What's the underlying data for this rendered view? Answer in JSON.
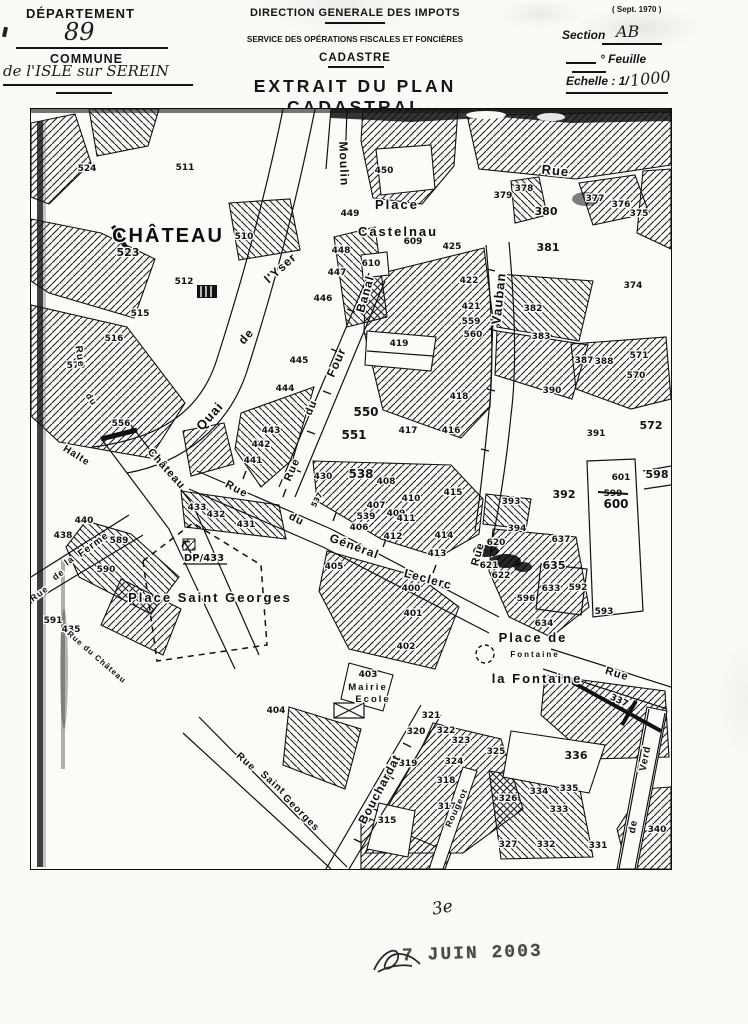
{
  "header": {
    "left": {
      "departement_label": "DÉPARTEMENT",
      "departement_value": "89",
      "commune_label": "COMMUNE",
      "commune_value": "de l'ISLE sur SEREIN"
    },
    "center": {
      "administration": "DIRECTION GENERALE DES IMPOTS",
      "service": "SERVICE DES OPÉRATIONS FISCALES ET FONCIÈRES",
      "cadastre": "CADASTRE",
      "title": "EXTRAIT DU PLAN CADASTRAL"
    },
    "right": {
      "edition": "( Sept. 1970 )",
      "section_label": "Section",
      "section_value": "AB",
      "feuille_label": "° Feuille",
      "echelle_label": "Echelle : 1/",
      "echelle_value": "1000"
    }
  },
  "map": {
    "places": [
      {
        "label": "CHÂTEAU",
        "x": 137,
        "y": 133,
        "fs": 20,
        "ls": 5
      },
      {
        "label": "Place",
        "x": 366,
        "y": 100,
        "fs": 13,
        "ls": 2
      },
      {
        "label": "Castelnau",
        "x": 367,
        "y": 127,
        "fs": 13,
        "ls": 1
      },
      {
        "label": "Place  Saint  Georges",
        "x": 179,
        "y": 493,
        "fs": 13,
        "ls": 1
      },
      {
        "label": "Place  de",
        "x": 502,
        "y": 533,
        "fs": 13,
        "ls": 1
      },
      {
        "label": "la Fontaine",
        "x": 506,
        "y": 574,
        "fs": 13,
        "ls": 1
      },
      {
        "label": "Fontaine",
        "x": 504,
        "y": 548,
        "fs": 8,
        "ls": 0
      },
      {
        "label": "Mairie",
        "x": 337,
        "y": 581,
        "fs": 9.5,
        "ls": 1
      },
      {
        "label": "Ecole",
        "x": 342,
        "y": 593,
        "fs": 9.5,
        "ls": 1
      }
    ],
    "streets": [
      {
        "label": "Moulin",
        "x": 309,
        "y": 55,
        "r": 88,
        "fs": 12
      },
      {
        "label": "Rue",
        "x": 524,
        "y": 66,
        "r": 6,
        "fs": 13
      },
      {
        "label": "Quai",
        "x": 182,
        "y": 310,
        "r": -48,
        "fs": 13
      },
      {
        "label": "de",
        "x": 218,
        "y": 230,
        "r": -48,
        "fs": 12
      },
      {
        "label": "l'Yser",
        "x": 252,
        "y": 162,
        "r": -42,
        "fs": 12
      },
      {
        "label": "Rue",
        "x": 264,
        "y": 362,
        "r": -66,
        "fs": 11
      },
      {
        "label": "du",
        "x": 283,
        "y": 300,
        "r": -66,
        "fs": 11
      },
      {
        "label": "Four",
        "x": 309,
        "y": 255,
        "r": -66,
        "fs": 12
      },
      {
        "label": "Banal",
        "x": 338,
        "y": 186,
        "r": -74,
        "fs": 12
      },
      {
        "label": "Vauban",
        "x": 472,
        "y": 190,
        "r": -84,
        "fs": 13
      },
      {
        "label": "Rue",
        "x": 450,
        "y": 446,
        "r": -75,
        "fs": 11
      },
      {
        "label": "Rue",
        "x": 204,
        "y": 383,
        "r": 28,
        "fs": 11
      },
      {
        "label": "du",
        "x": 264,
        "y": 413,
        "r": 28,
        "fs": 11
      },
      {
        "label": "Général",
        "x": 322,
        "y": 441,
        "r": 20,
        "fs": 12
      },
      {
        "label": "Leclerc",
        "x": 396,
        "y": 474,
        "r": 15,
        "fs": 12
      },
      {
        "label": "Bouchardat",
        "x": 352,
        "y": 682,
        "r": -62,
        "fs": 12
      },
      {
        "label": "Rue",
        "x": 213,
        "y": 655,
        "r": 42,
        "fs": 10
      },
      {
        "label": "Saint",
        "x": 240,
        "y": 676,
        "r": 42,
        "fs": 10
      },
      {
        "label": "Georges",
        "x": 268,
        "y": 706,
        "r": 45,
        "fs": 10
      },
      {
        "label": "Rue",
        "x": 46,
        "y": 248,
        "r": 82,
        "fs": 10
      },
      {
        "label": "du",
        "x": 58,
        "y": 292,
        "r": 55,
        "fs": 9
      },
      {
        "label": "Château",
        "x": 133,
        "y": 362,
        "r": 48,
        "fs": 11
      },
      {
        "label": "Halte",
        "x": 44,
        "y": 349,
        "r": 32,
        "fs": 10
      },
      {
        "label": "Rue du Château",
        "x": 64,
        "y": 550,
        "r": 41,
        "fs": 8
      },
      {
        "label": "Rue",
        "x": 10,
        "y": 487,
        "r": -36,
        "fs": 9
      },
      {
        "label": "de",
        "x": 29,
        "y": 468,
        "r": -36,
        "fs": 9
      },
      {
        "label": "la",
        "x": 40,
        "y": 454,
        "r": -36,
        "fs": 9
      },
      {
        "label": "Ferme",
        "x": 64,
        "y": 438,
        "r": -36,
        "fs": 10
      },
      {
        "label": "Rue",
        "x": 585,
        "y": 568,
        "r": 17,
        "fs": 11
      },
      {
        "label": "Verd",
        "x": 617,
        "y": 650,
        "r": -79,
        "fs": 10
      },
      {
        "label": "de",
        "x": 605,
        "y": 718,
        "r": -79,
        "fs": 10
      },
      {
        "label": "Rougeot",
        "x": 428,
        "y": 700,
        "r": -65,
        "fs": 8.5
      }
    ],
    "parcels": [
      {
        "n": "524",
        "x": 56,
        "y": 62
      },
      {
        "n": "511",
        "x": 154,
        "y": 61
      },
      {
        "n": "510",
        "x": 213,
        "y": 130
      },
      {
        "n": "523",
        "x": 97,
        "y": 147,
        "fs": 11
      },
      {
        "n": "512",
        "x": 153,
        "y": 175
      },
      {
        "n": "515",
        "x": 109,
        "y": 207
      },
      {
        "n": "516",
        "x": 83,
        "y": 232
      },
      {
        "n": "570",
        "x": 45,
        "y": 259
      },
      {
        "n": "556",
        "x": 90,
        "y": 317
      },
      {
        "n": "440",
        "x": 53,
        "y": 414
      },
      {
        "n": "438",
        "x": 32,
        "y": 429
      },
      {
        "n": "589",
        "x": 88,
        "y": 434
      },
      {
        "n": "590",
        "x": 75,
        "y": 463
      },
      {
        "n": "591",
        "x": 22,
        "y": 514
      },
      {
        "n": "435",
        "x": 40,
        "y": 523
      },
      {
        "n": "450",
        "x": 353,
        "y": 64
      },
      {
        "n": "449",
        "x": 319,
        "y": 107
      },
      {
        "n": "448",
        "x": 310,
        "y": 144
      },
      {
        "n": "447",
        "x": 306,
        "y": 166
      },
      {
        "n": "446",
        "x": 292,
        "y": 192
      },
      {
        "n": "609",
        "x": 382,
        "y": 135
      },
      {
        "n": "610",
        "x": 340,
        "y": 157
      },
      {
        "n": "425",
        "x": 421,
        "y": 140
      },
      {
        "n": "422",
        "x": 438,
        "y": 174
      },
      {
        "n": "421",
        "x": 440,
        "y": 200
      },
      {
        "n": "559",
        "x": 440,
        "y": 215
      },
      {
        "n": "560",
        "x": 442,
        "y": 228
      },
      {
        "n": "419",
        "x": 368,
        "y": 237
      },
      {
        "n": "445",
        "x": 268,
        "y": 254
      },
      {
        "n": "444",
        "x": 254,
        "y": 282
      },
      {
        "n": "443",
        "x": 240,
        "y": 324
      },
      {
        "n": "442",
        "x": 230,
        "y": 338
      },
      {
        "n": "441",
        "x": 222,
        "y": 354
      },
      {
        "n": "550",
        "x": 335,
        "y": 307,
        "fs": 12
      },
      {
        "n": "551",
        "x": 323,
        "y": 330,
        "fs": 12
      },
      {
        "n": "379",
        "x": 472,
        "y": 89
      },
      {
        "n": "378",
        "x": 493,
        "y": 82
      },
      {
        "n": "380",
        "x": 515,
        "y": 106,
        "fs": 11
      },
      {
        "n": "381",
        "x": 517,
        "y": 142,
        "fs": 11
      },
      {
        "n": "377",
        "x": 564,
        "y": 92
      },
      {
        "n": "376",
        "x": 590,
        "y": 98
      },
      {
        "n": "375",
        "x": 608,
        "y": 107
      },
      {
        "n": "374",
        "x": 602,
        "y": 179
      },
      {
        "n": "382",
        "x": 502,
        "y": 202
      },
      {
        "n": "383",
        "x": 510,
        "y": 230
      },
      {
        "n": "418",
        "x": 428,
        "y": 290
      },
      {
        "n": "417",
        "x": 377,
        "y": 324
      },
      {
        "n": "416",
        "x": 420,
        "y": 324
      },
      {
        "n": "415",
        "x": 422,
        "y": 386
      },
      {
        "n": "414",
        "x": 413,
        "y": 429
      },
      {
        "n": "413",
        "x": 406,
        "y": 447
      },
      {
        "n": "387",
        "x": 553,
        "y": 254
      },
      {
        "n": "388",
        "x": 573,
        "y": 255
      },
      {
        "n": "571",
        "x": 608,
        "y": 249
      },
      {
        "n": "570",
        "x": 605,
        "y": 269
      },
      {
        "n": "390",
        "x": 521,
        "y": 284
      },
      {
        "n": "391",
        "x": 565,
        "y": 327
      },
      {
        "n": "572",
        "x": 620,
        "y": 320,
        "fs": 11
      },
      {
        "n": "598",
        "x": 626,
        "y": 369,
        "fs": 11
      },
      {
        "n": "601",
        "x": 590,
        "y": 371
      },
      {
        "n": "599",
        "x": 582,
        "y": 387,
        "strike": true
      },
      {
        "n": "600",
        "x": 585,
        "y": 399,
        "fs": 12
      },
      {
        "n": "430",
        "x": 292,
        "y": 370
      },
      {
        "n": "538",
        "x": 330,
        "y": 369,
        "fs": 12
      },
      {
        "n": "537",
        "x": 288,
        "y": 392,
        "r": -62,
        "fs": 7.5
      },
      {
        "n": "539",
        "x": 335,
        "y": 410
      },
      {
        "n": "408",
        "x": 355,
        "y": 375
      },
      {
        "n": "407",
        "x": 345,
        "y": 399
      },
      {
        "n": "409",
        "x": 365,
        "y": 407
      },
      {
        "n": "410",
        "x": 380,
        "y": 392
      },
      {
        "n": "411",
        "x": 375,
        "y": 412
      },
      {
        "n": "412",
        "x": 362,
        "y": 430
      },
      {
        "n": "406",
        "x": 328,
        "y": 421
      },
      {
        "n": "405",
        "x": 303,
        "y": 460
      },
      {
        "n": "400",
        "x": 380,
        "y": 482
      },
      {
        "n": "401",
        "x": 382,
        "y": 507
      },
      {
        "n": "402",
        "x": 375,
        "y": 540
      },
      {
        "n": "403",
        "x": 337,
        "y": 568
      },
      {
        "n": "404",
        "x": 245,
        "y": 604
      },
      {
        "n": "DP/433",
        "x": 173,
        "y": 452,
        "fs": 10
      },
      {
        "n": "433",
        "x": 166,
        "y": 401
      },
      {
        "n": "432",
        "x": 185,
        "y": 408
      },
      {
        "n": "431",
        "x": 215,
        "y": 418
      },
      {
        "n": "315",
        "x": 356,
        "y": 714
      },
      {
        "n": "317",
        "x": 416,
        "y": 700
      },
      {
        "n": "318",
        "x": 415,
        "y": 674
      },
      {
        "n": "319",
        "x": 377,
        "y": 657
      },
      {
        "n": "320",
        "x": 385,
        "y": 625
      },
      {
        "n": "321",
        "x": 400,
        "y": 609
      },
      {
        "n": "322",
        "x": 415,
        "y": 624
      },
      {
        "n": "323",
        "x": 430,
        "y": 634
      },
      {
        "n": "324",
        "x": 423,
        "y": 655
      },
      {
        "n": "325",
        "x": 465,
        "y": 645
      },
      {
        "n": "326",
        "x": 477,
        "y": 692
      },
      {
        "n": "327",
        "x": 477,
        "y": 738
      },
      {
        "n": "332",
        "x": 515,
        "y": 738
      },
      {
        "n": "333",
        "x": 528,
        "y": 703
      },
      {
        "n": "334",
        "x": 508,
        "y": 685
      },
      {
        "n": "335",
        "x": 538,
        "y": 682
      },
      {
        "n": "336",
        "x": 545,
        "y": 650,
        "fs": 11
      },
      {
        "n": "331",
        "x": 567,
        "y": 739
      },
      {
        "n": "340",
        "x": 626,
        "y": 723
      },
      {
        "n": "337",
        "x": 587,
        "y": 594,
        "r": 25
      },
      {
        "n": "620",
        "x": 465,
        "y": 436
      },
      {
        "n": "621",
        "x": 458,
        "y": 459
      },
      {
        "n": "622",
        "x": 470,
        "y": 469
      },
      {
        "n": "637",
        "x": 530,
        "y": 433
      },
      {
        "n": "635",
        "x": 523,
        "y": 460,
        "fs": 11
      },
      {
        "n": "633",
        "x": 520,
        "y": 482
      },
      {
        "n": "634",
        "x": 513,
        "y": 517
      },
      {
        "n": "596",
        "x": 495,
        "y": 492
      },
      {
        "n": "592",
        "x": 547,
        "y": 481
      },
      {
        "n": "593",
        "x": 573,
        "y": 505
      },
      {
        "n": "392",
        "x": 533,
        "y": 389,
        "fs": 11
      },
      {
        "n": "393",
        "x": 480,
        "y": 395
      },
      {
        "n": "394",
        "x": 486,
        "y": 422
      }
    ]
  },
  "footer": {
    "handwritten_note": "3e",
    "date_stamp": "7 JUIN 2003"
  }
}
